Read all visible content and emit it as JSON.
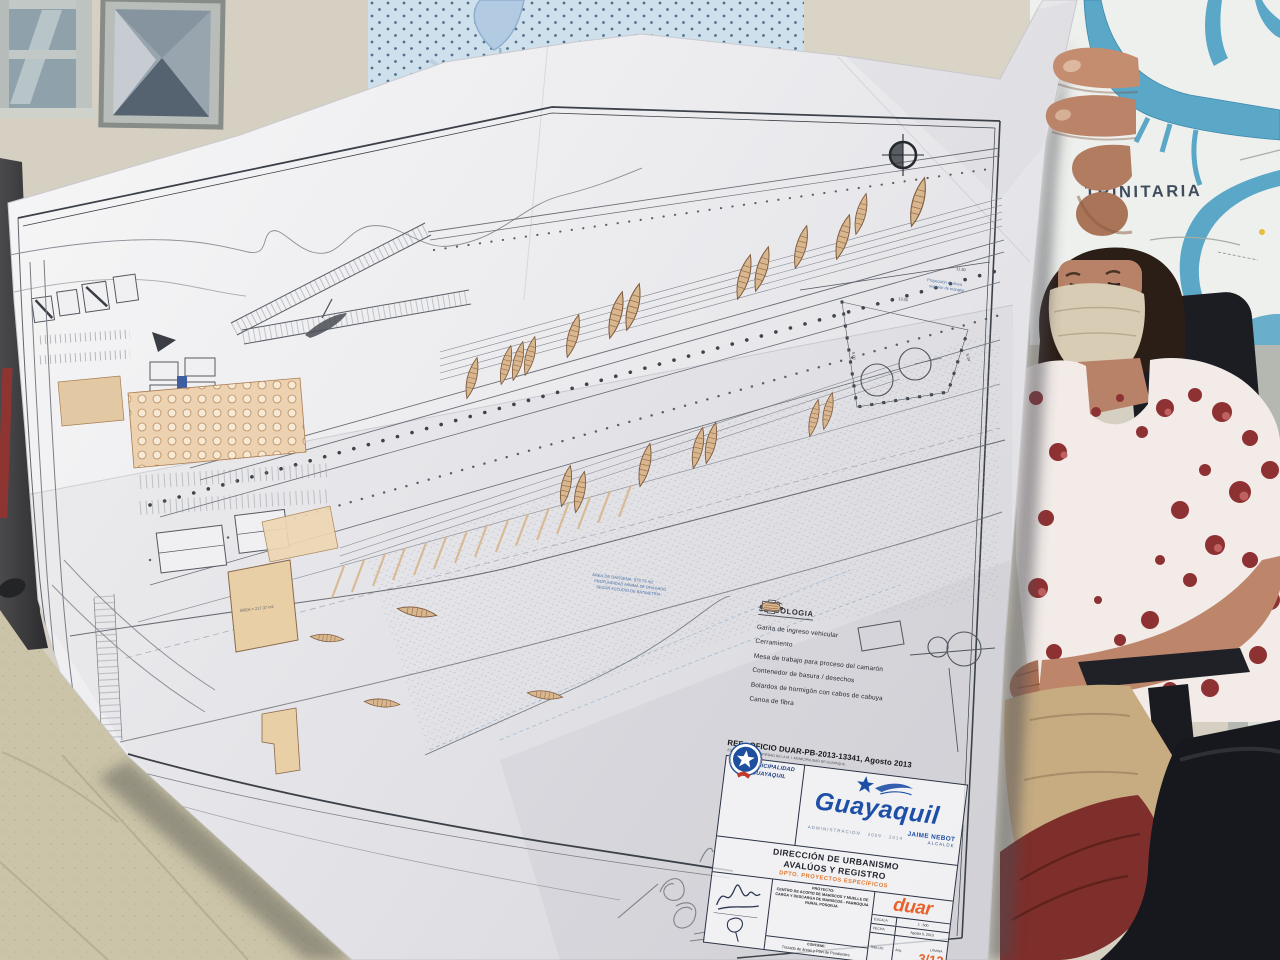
{
  "map": {
    "label": "TRINITARIA"
  },
  "plan": {
    "ref_line1": "REF.: OFICIO DUAR-PB-2013-13341, Agosto 2013",
    "ref_line2": "ESTE PLANO ES PROPIEDAD DE LA M. I. MUNICIPALIDAD DE GUAYAQUIL",
    "annotations": {
      "mangrove_1": "Proyección de línea",
      "mangrove_2": "superior de manglar",
      "basin_1": "ÁREA DE DÁRSENA: 975.73 m2",
      "basin_2": "PROFUNDIDAD MÍNIMA DE DRAGADO",
      "basin_3": "SEGÚN ESTUDIO DE BATIMETRÍA",
      "area_label": "ÁREA = 217.37 m2",
      "dim_1": "13.00",
      "dim_2": "5.00",
      "dim_3": "5.34",
      "dim_4": "11.50"
    },
    "legend": {
      "title": "SIMBOLOGIA",
      "items": [
        {
          "icon": "vehicle-gate-icon",
          "label": "Garita de ingreso vehicular"
        },
        {
          "icon": "fence-line-icon",
          "label": "Cerramiento"
        },
        {
          "icon": "work-table-icon",
          "label": "Mesa de trabajo para proceso del camarón"
        },
        {
          "icon": "waste-container-icon",
          "label": "Contenedor de basura / desechos"
        },
        {
          "icon": "bollard-icon",
          "label": "Bolardos de hormigón con cabos de cabuya"
        },
        {
          "icon": "fiber-canoe-icon",
          "label": "Canoa de fibra"
        }
      ]
    },
    "title_block": {
      "municipality_1": "M. I. MUNICIPALIDAD",
      "municipality_2": "DE GUAYAQUIL",
      "brand": "Guayaquil",
      "administration_label": "ADMINISTRACIÓN",
      "administration_years": "2009 - 2014",
      "mayor_name": "JAIME NEBOT",
      "mayor_title": "ALCALDE",
      "direction_1": "DIRECCIÓN DE URBANISMO",
      "direction_2": "AVALÚOS Y REGISTRO",
      "department": "DPTO. PROYECTOS ESPECÍFICOS",
      "project_label": "PROYECTO:",
      "project_name": "CENTRO DE ACOPIO DE MARISCOS Y MUELLE DE CARGA Y DESCARGA DE MARISCOS - PARROQUIA RURAL POSORJA",
      "contains_label": "CONTIENE:",
      "contains_value": "Trazado de áreas y Plan de Pendientes",
      "logo": "duar",
      "scale_label": "ESCALA",
      "scale_value": "1 : 500",
      "date_label": "FECHA",
      "date_value": "Agosto 5, 2013",
      "sheet_label": "LÁMINA",
      "sheet_value": "3/12",
      "drawn_label": "DIBUJO",
      "drawn_value": "Arq."
    }
  },
  "colors": {
    "brand_blue": "#1D4FA6",
    "accent_orange": "#E8622D",
    "canoe_tan": "#D8B68E",
    "river_blue": "#5AA7C8",
    "chair_black": "#17181D"
  }
}
